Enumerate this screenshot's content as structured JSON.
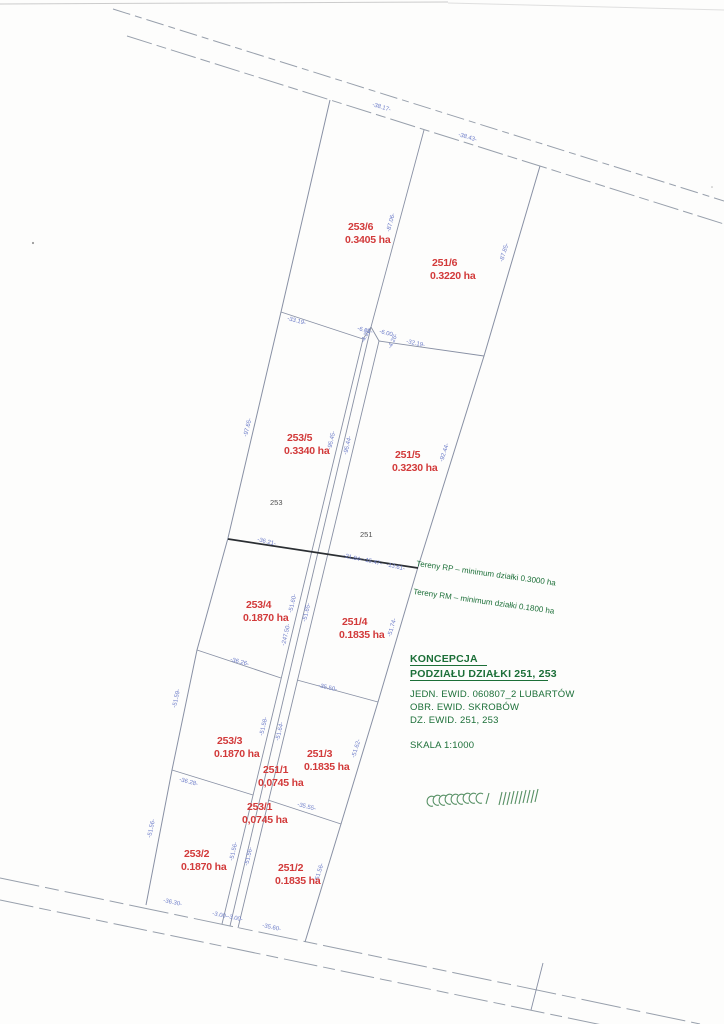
{
  "parcels": [
    {
      "id": "253/6",
      "area": "0.3405 ha"
    },
    {
      "id": "251/6",
      "area": "0.3220 ha"
    },
    {
      "id": "253/5",
      "area": "0.3340 ha"
    },
    {
      "id": "251/5",
      "area": "0.3230 ha"
    },
    {
      "id": "253/4",
      "area": "0.1870 ha"
    },
    {
      "id": "251/4",
      "area": "0.1835 ha"
    },
    {
      "id": "253/3",
      "area": "0.1870 ha"
    },
    {
      "id": "251/3",
      "area": "0.1835 ha"
    },
    {
      "id": "251/1",
      "area": "0,0745 ha"
    },
    {
      "id": "253/1",
      "area": "0,0745 ha"
    },
    {
      "id": "253/2",
      "area": "0.1870 ha"
    },
    {
      "id": "251/2",
      "area": "0.1835 ha"
    }
  ],
  "parent_parcels": {
    "left": "253",
    "right": "251"
  },
  "dim_labels": [
    "-38.17-",
    "-38.43-",
    "-87.06-",
    "-87.85-",
    "-33.19-",
    "-6.01-",
    "-6.00-",
    "-4.27-",
    "-4.26-",
    "-32.19-",
    "-97.65-",
    "-95.45-",
    "-95.44-",
    "-92.44-",
    "-36.21-",
    "-21.84-",
    "-15.47-",
    "-13.61-",
    "-51.60-",
    "-51.65-",
    "-247.50-",
    "-36.26-",
    "-35.50-",
    "-51.59-",
    "-51.74-",
    "-51.58-",
    "-51.64-",
    "-51.62-",
    "-36.28-",
    "-35.55-",
    "-51.56-",
    "-51.56-",
    "-51.56-",
    "-51.56-",
    "-36.30-",
    "-3.00-",
    "-3.00-",
    "-35.60-"
  ],
  "zoning_notes": {
    "rp": "Tereny RP – minimum działki 0.3000 ha",
    "rm": "Tereny RM – minimum działki 0.1800 ha"
  },
  "title_block": {
    "title_line1": "KONCEPCJA",
    "title_line2": "PODZIAŁU DZIAŁKI 251, 253",
    "jedn_ewid": "JEDN. EWID. 060807_2 LUBARTÓW",
    "obr_ewid": "OBR. EWID. SKROBÓW",
    "dz_ewid": "DZ. EWID. 251, 253",
    "scale": "SKALA 1:1000"
  },
  "colors": {
    "parcel_label": "#d23a3a",
    "dimension_label": "#6b7bc8",
    "annotation_green": "#1c6f38",
    "boundary_line": "#8890a4",
    "terrain_line": "#2b2f33"
  }
}
